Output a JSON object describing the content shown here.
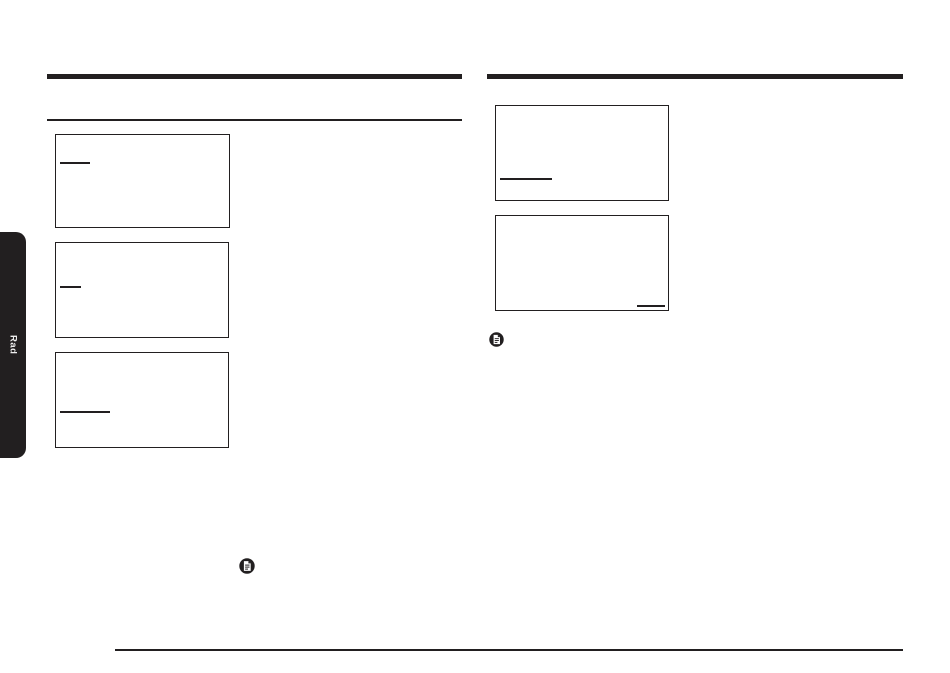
{
  "page": {
    "background": "#ffffff",
    "ink_color": "#221f20"
  },
  "side_tab": {
    "label": "Rad",
    "text_color": "#ededed"
  },
  "left_section": {
    "display_boxes": [
      {
        "x": 55,
        "y": 134,
        "w": 175,
        "h": 94,
        "underline": {
          "dx": 4,
          "dy": 27,
          "len": 30
        }
      },
      {
        "x": 55,
        "y": 242,
        "w": 174,
        "h": 96,
        "underline": {
          "dx": 4,
          "dy": 43,
          "len": 21
        }
      },
      {
        "x": 55,
        "y": 352,
        "w": 174,
        "h": 96,
        "underline": {
          "dx": 4,
          "dy": 58,
          "len": 50
        }
      }
    ],
    "note_icon": "note-icon"
  },
  "right_section": {
    "display_boxes": [
      {
        "x": 495,
        "y": 105,
        "w": 174,
        "h": 96,
        "underline": {
          "dx": 4,
          "dy": 72,
          "len": 52
        }
      },
      {
        "x": 495,
        "y": 215,
        "w": 174,
        "h": 96,
        "underline": {
          "dx": 141,
          "dy": 89,
          "len": 28
        }
      }
    ],
    "note_icon": "note-icon"
  },
  "icons": [
    {
      "name": "note-icon",
      "glyph": "document-with-lines-in-circle",
      "x": 239,
      "y": 558,
      "size": 16
    },
    {
      "name": "note-icon",
      "glyph": "document-with-lines-in-circle",
      "x": 489,
      "y": 332,
      "size": 15
    }
  ]
}
